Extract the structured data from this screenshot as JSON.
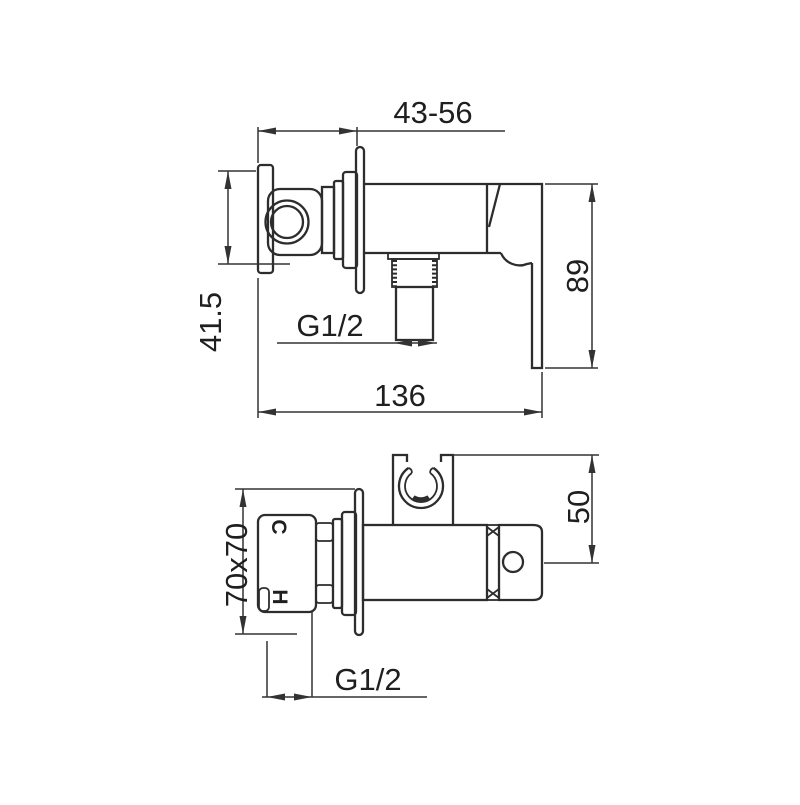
{
  "page": {
    "background": "#ffffff"
  },
  "colors": {
    "ink": "#2d2d2d",
    "dim_line": "#333333",
    "text": "#1f1f1f"
  },
  "top_view": {
    "width_range": "43-56",
    "offset_height": "41.5",
    "outlet_thread": "G1/2",
    "total_length": "136",
    "handle_length": "89"
  },
  "bottom_view": {
    "plate_size": "70x70",
    "cold_label": "C",
    "hot_label": "H",
    "holder_height": "50",
    "inlet_thread": "G1/2"
  }
}
